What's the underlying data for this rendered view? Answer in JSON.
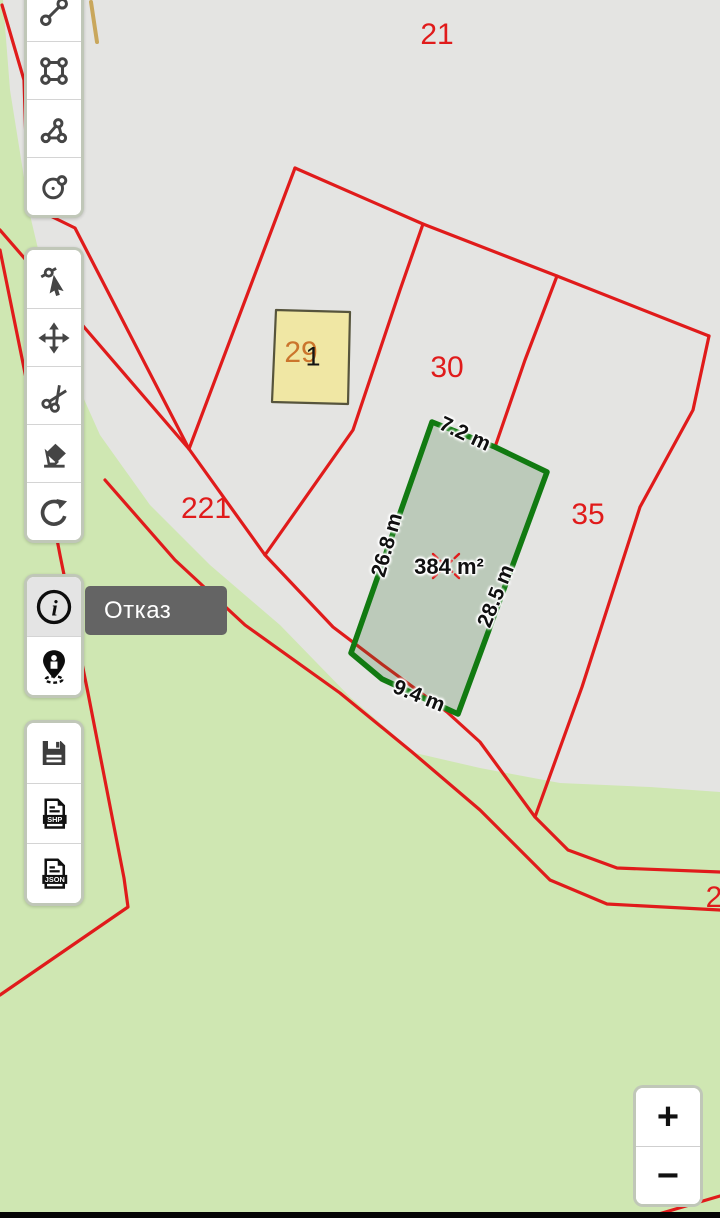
{
  "app": {
    "context": "cadastral-map-editor"
  },
  "tooltip": {
    "text": "Отказ"
  },
  "zoom_control": {
    "zoom_in": "+",
    "zoom_out": "−"
  },
  "icons": {
    "info_glyph": "i",
    "shp_badge": "SHP",
    "json_badge": "JSON",
    "draw_tools": [
      "line-tool-icon",
      "rectangle-tool-icon",
      "polygon-tool-icon",
      "circle-tool-icon"
    ],
    "edit_tools": [
      "select-vertex-icon",
      "move-icon",
      "scissors-icon",
      "eraser-icon",
      "undo-icon"
    ],
    "info_tools": [
      "info-icon",
      "person-pin-icon"
    ],
    "export_tools": [
      "save-icon",
      "shp-file-icon",
      "json-file-icon"
    ]
  },
  "map": {
    "colors": {
      "green_base": "#cfe7b2",
      "gray_area": "#e4e4e2",
      "red_line": "#e01b1b",
      "parcel_stroke": "#117a11",
      "parcel_fill": "rgba(45,110,45,0.22)",
      "building_fill": "#f0e7a4",
      "building_stroke": "#56543c",
      "tan_path": "#c9a75c"
    },
    "geometry": [
      {
        "shape": "polygon",
        "points": "3,0 720,0 720,792 650,787 560,783 480,768 415,753 350,697 280,625 210,565 150,505 100,435 62,350 30,215 10,90",
        "fill": "#e4e4e2",
        "stroke": "none",
        "sw": 0
      },
      {
        "shape": "polyline",
        "points": "91,2 97,42",
        "stroke": "#c9a75c",
        "sw": 4
      },
      {
        "shape": "polyline",
        "points": "2,5 24,80 28,205",
        "stroke": "#e01b1b",
        "sw": 3.2
      },
      {
        "shape": "polyline",
        "points": "28,205 75,228 189,449",
        "stroke": "#e01b1b",
        "sw": 3.2
      },
      {
        "shape": "polyline",
        "points": "0,230 84,327 189,449",
        "stroke": "#e01b1b",
        "sw": 3.2
      },
      {
        "shape": "polyline",
        "points": "0,250 26,378 60,555 88,693 124,878 128,907 0,995",
        "stroke": "#e01b1b",
        "sw": 3.2
      },
      {
        "shape": "polyline",
        "points": "295,168 189,449",
        "stroke": "#e01b1b",
        "sw": 3.2
      },
      {
        "shape": "polyline",
        "points": "295,168 423,224 557,276 709,336",
        "stroke": "#e01b1b",
        "sw": 3.2
      },
      {
        "shape": "polyline",
        "points": "423,224 400,290 353,430 265,555",
        "stroke": "#e01b1b",
        "sw": 3.2
      },
      {
        "shape": "polyline",
        "points": "557,276 525,360 495,447",
        "stroke": "#e01b1b",
        "sw": 3.2
      },
      {
        "shape": "polyline",
        "points": "709,336 693,410 640,507 582,687 535,817",
        "stroke": "#e01b1b",
        "sw": 3.2
      },
      {
        "shape": "polyline",
        "points": "189,449 265,555 333,627 383,665 447,712 480,742 535,817 568,850 617,868 720,872",
        "stroke": "#e01b1b",
        "sw": 3.2
      },
      {
        "shape": "polyline",
        "points": "105,480 175,560 245,625 340,693 412,752 480,810 550,880 607,904 720,910",
        "stroke": "#e01b1b",
        "sw": 3.2
      },
      {
        "shape": "polyline",
        "points": "720,1196 645,1218",
        "stroke": "#e01b1b",
        "sw": 3.2
      },
      {
        "shape": "polygon",
        "points": "276,310 350,312 348,404 272,402",
        "fill": "#f0e7a4",
        "stroke": "#56543c",
        "sw": 2.2
      },
      {
        "shape": "polygon",
        "points": "432,422 495,447 547,472 458,714 382,679 351,653",
        "fill": "rgba(45,110,45,0.22)",
        "stroke": "#117a11",
        "sw": 5.5
      },
      {
        "shape": "polyline",
        "points": "433,554 459,578",
        "stroke": "#e01b1b",
        "sw": 2.4,
        "dash": "6,4"
      },
      {
        "shape": "polyline",
        "points": "459,554 433,578",
        "stroke": "#e01b1b",
        "sw": 2.4,
        "dash": "6,4"
      }
    ],
    "labels": [
      {
        "text": "21",
        "x": 437,
        "y": 35,
        "rot": 0,
        "cls": "parcel"
      },
      {
        "text": "30",
        "x": 447,
        "y": 368,
        "rot": 0,
        "cls": "parcel"
      },
      {
        "text": "35",
        "x": 588,
        "y": 515,
        "rot": 0,
        "cls": "parcel"
      },
      {
        "text": "221",
        "x": 206,
        "y": 509,
        "rot": 0,
        "cls": "parcel"
      },
      {
        "text": "2",
        "x": 714,
        "y": 898,
        "rot": 0,
        "cls": "parcel"
      },
      {
        "text": "29",
        "x": 301,
        "y": 353,
        "rot": 0,
        "cls": "bnum"
      },
      {
        "text": "1",
        "x": 313,
        "y": 357,
        "rot": 0,
        "cls": "bnum2"
      },
      {
        "text": "7.2 m",
        "x": 465,
        "y": 434,
        "rot": 25,
        "cls": "measure"
      },
      {
        "text": "26.8 m",
        "x": 387,
        "y": 545,
        "rot": -74,
        "cls": "measure"
      },
      {
        "text": "28.5 m",
        "x": 496,
        "y": 596,
        "rot": -68,
        "cls": "measure"
      },
      {
        "text": "9.4 m",
        "x": 419,
        "y": 696,
        "rot": 22,
        "cls": "measure"
      },
      {
        "text": "384 m²",
        "x": 449,
        "y": 567,
        "rot": 0,
        "cls": "area"
      }
    ],
    "measurement_summary": {
      "area": "384 m²",
      "sides": [
        "7.2 m",
        "26.8 m",
        "28.5 m",
        "9.4 m"
      ],
      "parcel_numbers": [
        "21",
        "30",
        "35",
        "221",
        "2"
      ],
      "building_numbers": [
        "29",
        "1"
      ]
    }
  }
}
